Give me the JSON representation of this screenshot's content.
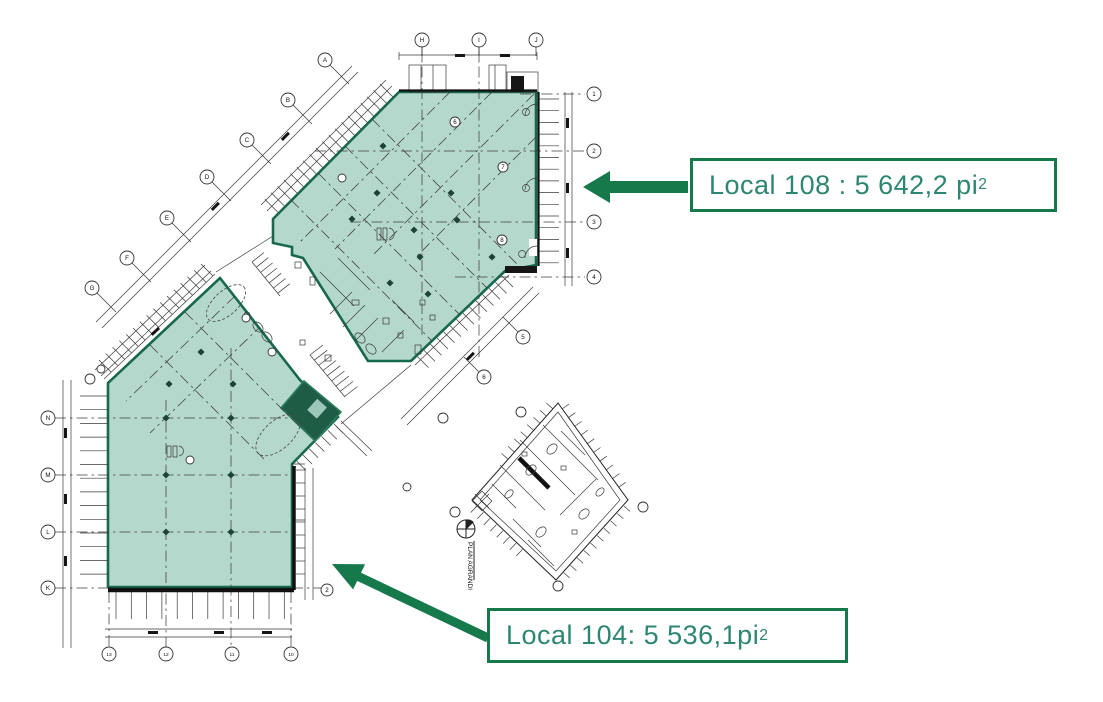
{
  "annotations": {
    "local108": {
      "text": "Local 108 : 5 642,2 pi",
      "sup": "2"
    },
    "local104": {
      "text": "Local 104: 5 536,1pi",
      "sup": "2"
    }
  },
  "colors": {
    "area_fill": "#b5d8cd",
    "area_outline": "#17684c",
    "dark_room": "#1e5c46",
    "arrow_green": "#15794b",
    "label_text": "#2d8672",
    "linework": "#3a3a3a"
  },
  "plan": {
    "detail_label": "PLAN AGRANDI",
    "markers": [
      {
        "x": 325,
        "y": 60,
        "label": "A",
        "leader": [
          24,
          24
        ]
      },
      {
        "x": 288,
        "y": 100,
        "label": "B",
        "leader": [
          24,
          24
        ]
      },
      {
        "x": 247,
        "y": 140,
        "label": "C",
        "leader": [
          24,
          24
        ]
      },
      {
        "x": 207,
        "y": 177,
        "label": "D",
        "leader": [
          24,
          24
        ]
      },
      {
        "x": 167,
        "y": 218,
        "label": "E",
        "leader": [
          24,
          24
        ]
      },
      {
        "x": 127,
        "y": 258,
        "label": "F",
        "leader": [
          24,
          24
        ]
      },
      {
        "x": 92,
        "y": 288,
        "label": "G",
        "leader": [
          24,
          24
        ]
      },
      {
        "x": 422,
        "y": 40,
        "label": "H",
        "leader": [
          0,
          16
        ]
      },
      {
        "x": 479,
        "y": 40,
        "label": "I",
        "leader": [
          0,
          16
        ]
      },
      {
        "x": 536,
        "y": 40,
        "label": "J",
        "leader": [
          0,
          16
        ]
      },
      {
        "x": 594,
        "y": 94,
        "label": "1"
      },
      {
        "x": 594,
        "y": 151,
        "label": "2"
      },
      {
        "x": 594,
        "y": 222,
        "label": "3"
      },
      {
        "x": 594,
        "y": 277,
        "label": "4"
      },
      {
        "x": 48,
        "y": 418,
        "label": "N"
      },
      {
        "x": 48,
        "y": 475,
        "label": "M"
      },
      {
        "x": 48,
        "y": 532,
        "label": "L"
      },
      {
        "x": 48,
        "y": 588,
        "label": "K"
      },
      {
        "x": 109,
        "y": 654,
        "label": "13"
      },
      {
        "x": 166,
        "y": 654,
        "label": "12"
      },
      {
        "x": 232,
        "y": 654,
        "label": "11"
      },
      {
        "x": 291,
        "y": 654,
        "label": "10"
      },
      {
        "x": 523,
        "y": 337,
        "label": "5",
        "leader": [
          -20,
          -20
        ]
      },
      {
        "x": 484,
        "y": 377,
        "label": "6",
        "leader": [
          -20,
          -20
        ]
      },
      {
        "x": 327,
        "y": 590,
        "label": "2",
        "r": 6
      },
      {
        "x": 455,
        "y": 122,
        "label": "6",
        "r": 5
      },
      {
        "x": 503,
        "y": 167,
        "label": "7",
        "r": 5
      },
      {
        "x": 502,
        "y": 240,
        "label": "8",
        "r": 5
      },
      {
        "x": 342,
        "y": 178,
        "label": "",
        "r": 4
      },
      {
        "x": 246,
        "y": 318,
        "label": "",
        "r": 4
      },
      {
        "x": 272,
        "y": 352,
        "label": "",
        "r": 4
      },
      {
        "x": 190,
        "y": 460,
        "label": "",
        "r": 4
      },
      {
        "x": 90,
        "y": 379,
        "label": "",
        "r": 5
      },
      {
        "x": 101,
        "y": 369,
        "label": "",
        "r": 4
      },
      {
        "x": 443,
        "y": 418,
        "label": "",
        "r": 5
      },
      {
        "x": 521,
        "y": 412,
        "label": "",
        "r": 5
      },
      {
        "x": 643,
        "y": 507,
        "label": "",
        "r": 5
      },
      {
        "x": 558,
        "y": 586,
        "label": "",
        "r": 5
      },
      {
        "x": 455,
        "y": 512,
        "label": "",
        "r": 5
      },
      {
        "x": 407,
        "y": 487,
        "label": "",
        "r": 4
      }
    ]
  }
}
